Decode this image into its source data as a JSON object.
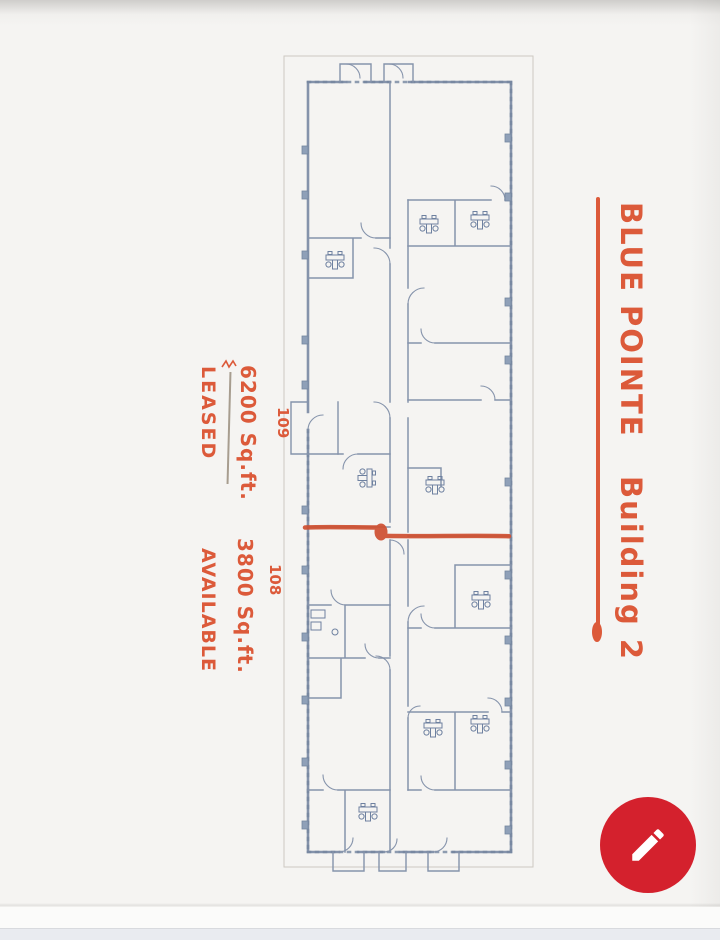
{
  "scan": {
    "title": {
      "line1": "BLUE POINTE",
      "line2": "Building 2"
    },
    "left_notes": {
      "leased_label": "LEASED",
      "leased_area": "6200 Sq.ft.",
      "available_label": "AVAILABLE",
      "available_area": "3800 Sq.ft."
    },
    "suites": {
      "upper": "109",
      "lower": "108"
    }
  },
  "fab": {
    "icon": "pencil-icon"
  },
  "colors": {
    "marker_red": "#dc5a3a",
    "divider_red": "#cf4f30",
    "fab_red": "#d4212d",
    "plan_line": "#8593ab",
    "plan_dark": "#74869f",
    "paper": "#f5f4f2",
    "bottom_bar": "#e9ebf0",
    "thin_line": "#a79d8f"
  }
}
